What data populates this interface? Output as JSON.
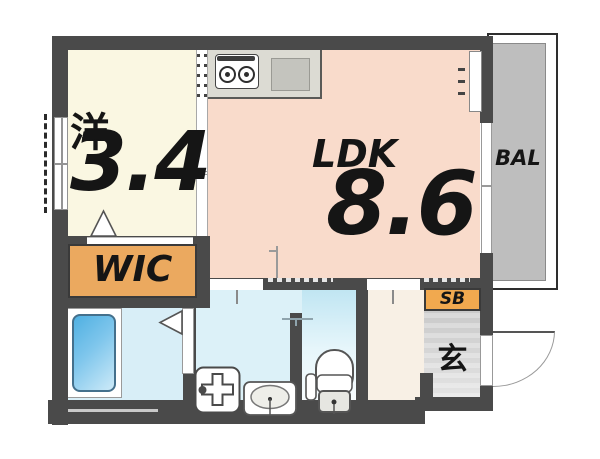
{
  "floorplan": {
    "rooms": {
      "western": {
        "label": "洋",
        "size": "3.4"
      },
      "ldk": {
        "label": "LDK",
        "size": "8.6"
      },
      "wic": {
        "label": "WIC"
      },
      "balcony": {
        "label": "BAL"
      },
      "shoebox": {
        "label": "SB"
      },
      "entrance": {
        "label": "玄"
      }
    },
    "fixtures": {
      "stove": "gas-stove-2-burner",
      "kitchen_sink": "kitchen-sink",
      "bathtub": "bathtub",
      "washer": "washing-machine-pan",
      "basin": "washbasin",
      "toilet": "toilet",
      "entrance_door": "entrance-door-swing"
    },
    "colors": {
      "wall": "#4a4a4a",
      "western_room": "#faf7e2",
      "ldk": "#f9dbcb",
      "kitchen_counter": "#dcdbd3",
      "wic": "#eba95f",
      "shoebox": "#f1a94f",
      "balcony": "#bebebe",
      "bathroom_floor": "#d8eef7",
      "bathtub": "#4fb0e2",
      "washroom_floor": "#dcf1f8",
      "toilet_floor": "#bfe5f2",
      "hallway": "#f8f0e5",
      "entrance_floor": "#d2d2d2",
      "text": "#151515"
    }
  }
}
